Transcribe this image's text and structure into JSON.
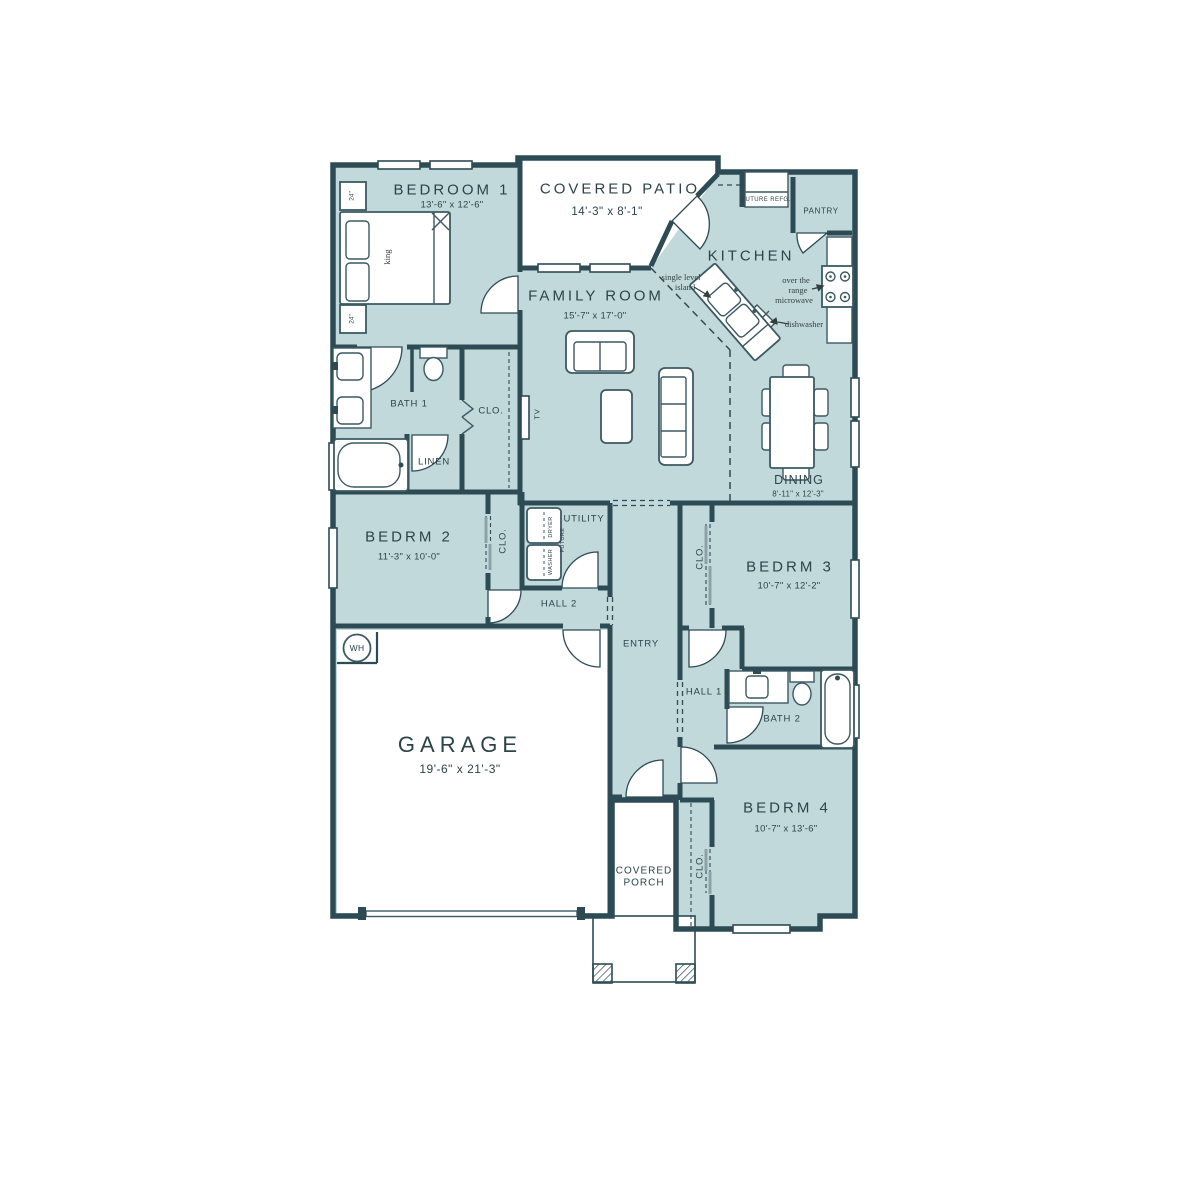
{
  "colors": {
    "floor": "#c2d9dc",
    "wall": "#2d4b54",
    "furniture": "#3c5962",
    "text": "#2c434a",
    "annotation": "#31403e",
    "slider_panel": "#8ea1a6"
  },
  "rooms": [
    {
      "name": "BEDROOM 1",
      "dims": "13'-6\" x 12'-6\""
    },
    {
      "name": "COVERED PATIO",
      "dims": "14'-3\" x 8'-1\""
    },
    {
      "name": "KITCHEN",
      "dims": ""
    },
    {
      "name": "PANTRY",
      "dims": ""
    },
    {
      "name": "FAMILY ROOM",
      "dims": "15'-7\" x 17'-0\""
    },
    {
      "name": "DINING",
      "dims": "8'-11\" x 12'-3\""
    },
    {
      "name": "BATH 1",
      "dims": ""
    },
    {
      "name": "LINEN",
      "dims": ""
    },
    {
      "name": "BEDRM 2",
      "dims": "11'-3\" x 10'-0\""
    },
    {
      "name": "UTILITY",
      "dims": ""
    },
    {
      "name": "HALL 2",
      "dims": ""
    },
    {
      "name": "ENTRY",
      "dims": ""
    },
    {
      "name": "BEDRM 3",
      "dims": "10'-7\" x 12'-2\""
    },
    {
      "name": "HALL 1",
      "dims": ""
    },
    {
      "name": "BATH 2",
      "dims": ""
    },
    {
      "name": "BEDRM 4",
      "dims": "10'-7\" x 13'-6\""
    },
    {
      "name": "GARAGE",
      "dims": "19'-6\" x 21'-3\""
    },
    {
      "name": "COVERED PORCH",
      "dims": ""
    }
  ],
  "labels": [
    {
      "id": "bedroom1-name",
      "t": "BEDROOM 1",
      "x": 452,
      "y": 190,
      "c": "rm-lg"
    },
    {
      "id": "bedroom1-dims",
      "t": "13'-6\" x 12'-6\"",
      "x": 452,
      "y": 205,
      "c": "dims"
    },
    {
      "id": "patio-name",
      "t": "COVERED PATIO",
      "x": 620,
      "y": 189,
      "c": "rm-lg"
    },
    {
      "id": "patio-dims",
      "t": "14'-3\" x 8'-1\"",
      "x": 607,
      "y": 212,
      "c": "dims-md"
    },
    {
      "id": "kitchen-name",
      "t": "KITCHEN",
      "x": 751,
      "y": 256,
      "c": "rm-lg"
    },
    {
      "id": "pantry-name",
      "t": "PANTRY",
      "x": 821,
      "y": 211,
      "c": "rm-xs"
    },
    {
      "id": "future-refg-label",
      "t": "FUTURE REFG.",
      "x": 766,
      "y": 200,
      "c": "tiny"
    },
    {
      "id": "island-note-1",
      "t": "single level",
      "x": 681,
      "y": 277,
      "c": "annot"
    },
    {
      "id": "island-note-2",
      "t": "island",
      "x": 685,
      "y": 287,
      "c": "annot"
    },
    {
      "id": "microwave-note-1",
      "t": "over the",
      "x": 796,
      "y": 280,
      "c": "annot"
    },
    {
      "id": "microwave-note-2",
      "t": "range",
      "x": 798,
      "y": 290,
      "c": "annot"
    },
    {
      "id": "microwave-note-3",
      "t": "microwave",
      "x": 794,
      "y": 300,
      "c": "annot"
    },
    {
      "id": "dishwasher-note",
      "t": "dishwasher",
      "x": 804,
      "y": 324,
      "c": "annot"
    },
    {
      "id": "family-name",
      "t": "FAMILY ROOM",
      "x": 596,
      "y": 296,
      "c": "rm-lg"
    },
    {
      "id": "family-dims",
      "t": "15'-7\" x 17'-0\"",
      "x": 595,
      "y": 316,
      "c": "dims"
    },
    {
      "id": "tv-label",
      "t": "TV",
      "x": 537,
      "y": 414,
      "c": "v-sm",
      "r": -90
    },
    {
      "id": "bath1-name",
      "t": "BATH 1",
      "x": 409,
      "y": 404,
      "c": "rm-sm"
    },
    {
      "id": "clo1-name",
      "t": "CLO.",
      "x": 491,
      "y": 411,
      "c": "rm-sm"
    },
    {
      "id": "linen-name",
      "t": "LINEN",
      "x": 434,
      "y": 462,
      "c": "rm-sm"
    },
    {
      "id": "dining-name",
      "t": "DINING",
      "x": 799,
      "y": 480,
      "c": "rm-md"
    },
    {
      "id": "dining-dims",
      "t": "8'-11\" x 12'-3\"",
      "x": 798,
      "y": 494,
      "c": "dims-sm"
    },
    {
      "id": "bedrm2-name",
      "t": "BEDRM 2",
      "x": 409,
      "y": 537,
      "c": "rm-lg"
    },
    {
      "id": "bedrm2-dims",
      "t": "11'-3\" x 10'-0\"",
      "x": 409,
      "y": 557,
      "c": "dims"
    },
    {
      "id": "clo2-name",
      "t": "CLO.",
      "x": 503,
      "y": 541,
      "c": "rm-sm",
      "r": -90
    },
    {
      "id": "utility-name",
      "t": "UTILITY",
      "x": 584,
      "y": 519,
      "c": "rm-sm"
    },
    {
      "id": "dryer-label",
      "t": "DRYER",
      "x": 551,
      "y": 527,
      "c": "v-xs",
      "r": -90
    },
    {
      "id": "washer-label",
      "t": "WASHER",
      "x": 551,
      "y": 562,
      "c": "v-xs",
      "r": -90
    },
    {
      "id": "future-label",
      "t": "FUTURE",
      "x": 563,
      "y": 540,
      "c": "v-xs",
      "r": -90
    },
    {
      "id": "hall2-name",
      "t": "HALL 2",
      "x": 559,
      "y": 604,
      "c": "rm-sm"
    },
    {
      "id": "entry-name",
      "t": "ENTRY",
      "x": 641,
      "y": 644,
      "c": "rm-sm"
    },
    {
      "id": "bedrm3-name",
      "t": "BEDRM 3",
      "x": 790,
      "y": 567,
      "c": "rm-lg"
    },
    {
      "id": "bedrm3-dims",
      "t": "10'-7\" x 12'-2\"",
      "x": 789,
      "y": 586,
      "c": "dims"
    },
    {
      "id": "clo3-name",
      "t": "CLO.",
      "x": 700,
      "y": 557,
      "c": "rm-sm",
      "r": -90
    },
    {
      "id": "hall1-name",
      "t": "HALL 1",
      "x": 704,
      "y": 692,
      "c": "rm-sm"
    },
    {
      "id": "bath2-name",
      "t": "BATH 2",
      "x": 782,
      "y": 719,
      "c": "rm-sm"
    },
    {
      "id": "bedrm4-name",
      "t": "BEDRM 4",
      "x": 787,
      "y": 808,
      "c": "rm-lg"
    },
    {
      "id": "bedrm4-dims",
      "t": "10'-7\" x 13'-6\"",
      "x": 786,
      "y": 829,
      "c": "dims"
    },
    {
      "id": "clo4-name",
      "t": "CLO.",
      "x": 700,
      "y": 866,
      "c": "rm-sm",
      "r": -90
    },
    {
      "id": "garage-name",
      "t": "GARAGE",
      "x": 460,
      "y": 745,
      "c": "rm-xl"
    },
    {
      "id": "garage-dims",
      "t": "19'-6\" x 21'-3\"",
      "x": 460,
      "y": 769,
      "c": "dims-lg"
    },
    {
      "id": "wh-label",
      "t": "WH",
      "x": 357,
      "y": 648,
      "c": "wh"
    },
    {
      "id": "porch-name-1",
      "t": "COVERED",
      "x": 644,
      "y": 871,
      "c": "rm-xs2"
    },
    {
      "id": "porch-name-2",
      "t": "PORCH",
      "x": 644,
      "y": 883,
      "c": "rm-xs2"
    },
    {
      "id": "king-label",
      "t": "king",
      "x": 387,
      "y": 257,
      "c": "annot serif",
      "r": -90
    },
    {
      "id": "nightstand1-label",
      "t": "24\"",
      "x": 352,
      "y": 196,
      "c": "v-xxs",
      "r": -90
    },
    {
      "id": "nightstand2-label",
      "t": "24\"",
      "x": 352,
      "y": 319,
      "c": "v-xxs",
      "r": -90
    }
  ]
}
